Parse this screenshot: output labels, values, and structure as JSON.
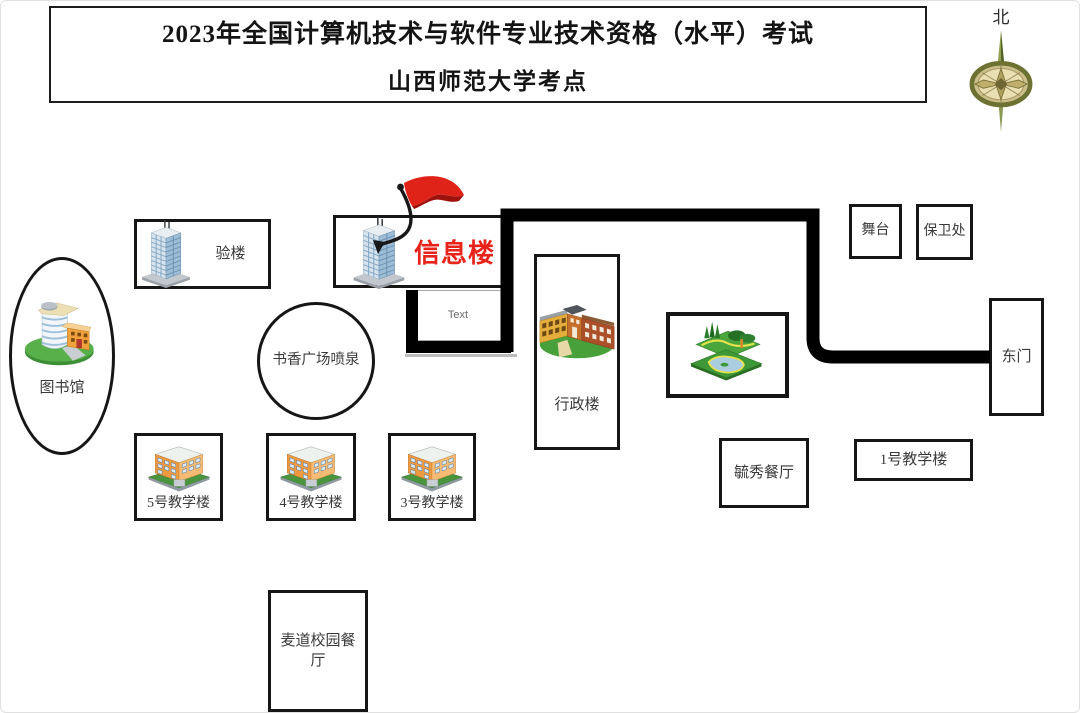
{
  "title": {
    "line1": "2023年全国计算机技术与软件专业技术资格（水平）考试",
    "line2": "山西师范大学考点"
  },
  "compass": {
    "label": "北"
  },
  "colors": {
    "accent_red": "#e8231c",
    "route_black": "#000000",
    "label_gray": "#3a3a3a"
  },
  "nodes": {
    "library": {
      "label": "图书馆",
      "icon": "library-building-icon",
      "shape": "ellipse"
    },
    "lab_building": {
      "label": "验楼",
      "icon": "skyscraper-icon",
      "shape": "rect"
    },
    "info_building": {
      "label": "信息楼",
      "icon": "skyscraper-icon",
      "shape": "rect",
      "marker": "red-flag",
      "highlight": "red"
    },
    "text_note": {
      "label": "Text",
      "shape": "rect"
    },
    "fountain": {
      "label": "书香广场喷泉",
      "shape": "circle"
    },
    "admin_building": {
      "label": "行政楼",
      "icon": "school-building-icon",
      "shape": "rect"
    },
    "park": {
      "label": "",
      "icon": "park-garden-icon",
      "shape": "rect"
    },
    "stage": {
      "label": "舞台",
      "shape": "rect"
    },
    "security_office": {
      "label": "保卫处",
      "shape": "rect"
    },
    "east_gate": {
      "label": "东门",
      "shape": "rect"
    },
    "yuxiu_dining": {
      "label": "毓秀餐厅",
      "shape": "rect"
    },
    "teaching_1": {
      "label": "1号教学楼",
      "shape": "rect"
    },
    "teaching_5": {
      "label": "5号教学楼",
      "icon": "classroom-building-icon",
      "shape": "rect"
    },
    "teaching_4": {
      "label": "4号教学楼",
      "icon": "classroom-building-icon",
      "shape": "rect"
    },
    "teaching_3": {
      "label": "3号教学楼",
      "icon": "classroom-building-icon",
      "shape": "rect"
    },
    "maidao_dining": {
      "label": "麦道校园餐厅",
      "shape": "rect"
    }
  }
}
